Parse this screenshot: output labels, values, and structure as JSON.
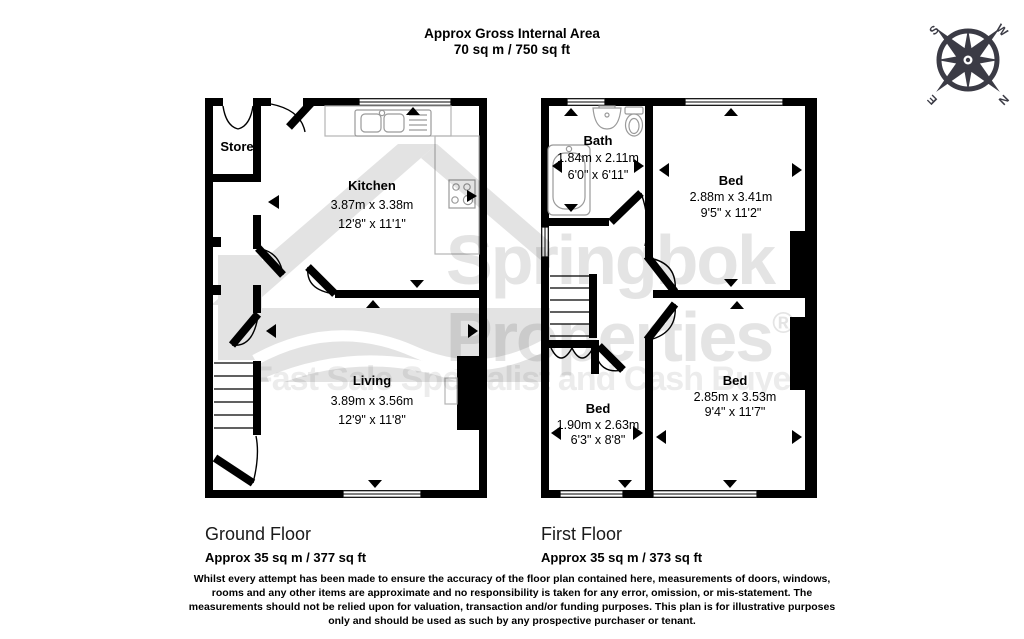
{
  "header": {
    "title": "Approx Gross Internal Area",
    "subtitle": "70 sq m / 750 sq ft"
  },
  "compass": {
    "n": "N",
    "s": "S",
    "e": "E",
    "w": "W",
    "color": "#3b3b45"
  },
  "floors": [
    {
      "label": "Ground Floor",
      "area": "Approx 35 sq m / 377 sq ft",
      "rooms": [
        {
          "name": "Store",
          "dims_m": "",
          "dims_ft": ""
        },
        {
          "name": "Kitchen",
          "dims_m": "3.87m x 3.38m",
          "dims_ft": "12'8\" x 11'1\""
        },
        {
          "name": "Living",
          "dims_m": "3.89m x 3.56m",
          "dims_ft": "12'9\" x 11'8\""
        }
      ]
    },
    {
      "label": "First Floor",
      "area": "Approx 35 sq m / 373 sq ft",
      "rooms": [
        {
          "name": "Bath",
          "dims_m": "1.84m x 2.11m",
          "dims_ft": "6'0\" x 6'11\""
        },
        {
          "name": "Bed",
          "dims_m": "2.88m x 3.41m",
          "dims_ft": "9'5\" x 11'2\""
        },
        {
          "name": "Bed",
          "dims_m": "1.90m x 2.63m",
          "dims_ft": "6'3\" x 8'8\""
        },
        {
          "name": "Bed",
          "dims_m": "2.85m x 3.53m",
          "dims_ft": "9'4\" x 11'7\""
        }
      ]
    }
  ],
  "watermark": {
    "brand_line1": "Springbok",
    "brand_line2": "Properties",
    "registered_mark": "®",
    "tagline": "Fast Sale Specialist and Cash Buyer",
    "brand_color": "#e4e4e4",
    "tagline_color": "#ececec"
  },
  "disclaimer": "Whilst every attempt has been made to ensure the accuracy of the floor plan contained here, measurements of doors, windows, rooms and any other items are approximate and no responsibility is taken for any error, omission, or mis-statement. The measurements should not be relied upon for valuation, transaction and/or funding purposes. This plan is for illustrative purposes only and should be used as such by any prospective purchaser or tenant.",
  "colors": {
    "wall": "#000000",
    "fixture": "#9a9a9a",
    "counter": "#b5b5b5",
    "watermark_shape": "#e3e3e3"
  }
}
